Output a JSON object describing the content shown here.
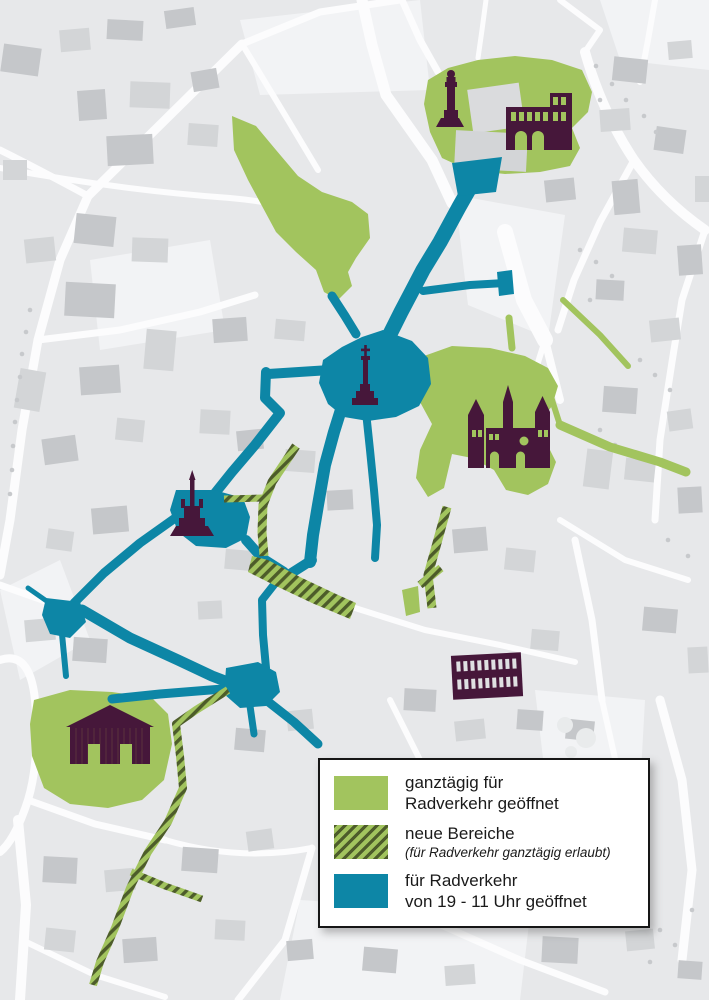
{
  "legend": {
    "items": [
      {
        "swatch": "green-solid",
        "line1": "ganztägig für",
        "line2": "Radverkehr geöffnet"
      },
      {
        "swatch": "green-hatched",
        "line1": "neue Bereiche",
        "note": "(für Radverkehr ganztägig erlaubt)"
      },
      {
        "swatch": "teal-solid",
        "line1": "für Radverkehr",
        "line2": "von 19 - 11 Uhr geöffnet"
      }
    ]
  },
  "map": {
    "landmark_icons": [
      "statue-monument-icon",
      "city-gate-building-icon",
      "cathedral-icon",
      "market-cross-icon",
      "fountain-icon",
      "arcaded-building-icon",
      "pillared-hall-icon"
    ],
    "zones": [
      "open-all-day-green",
      "new-areas-hatched",
      "timed-19-11-teal"
    ]
  },
  "colors": {
    "green": "#a2c45e",
    "hatch_stripe": "#4d5c2a",
    "teal": "#0d86a6",
    "landmark": "#46173a",
    "street": "#fcfcfd",
    "block": "#e7e8ea",
    "block_light": "#f2f3f5",
    "building_dark": "#c5c7ca",
    "building_mid": "#d3d5d7",
    "tree": "#c7c9cc"
  }
}
